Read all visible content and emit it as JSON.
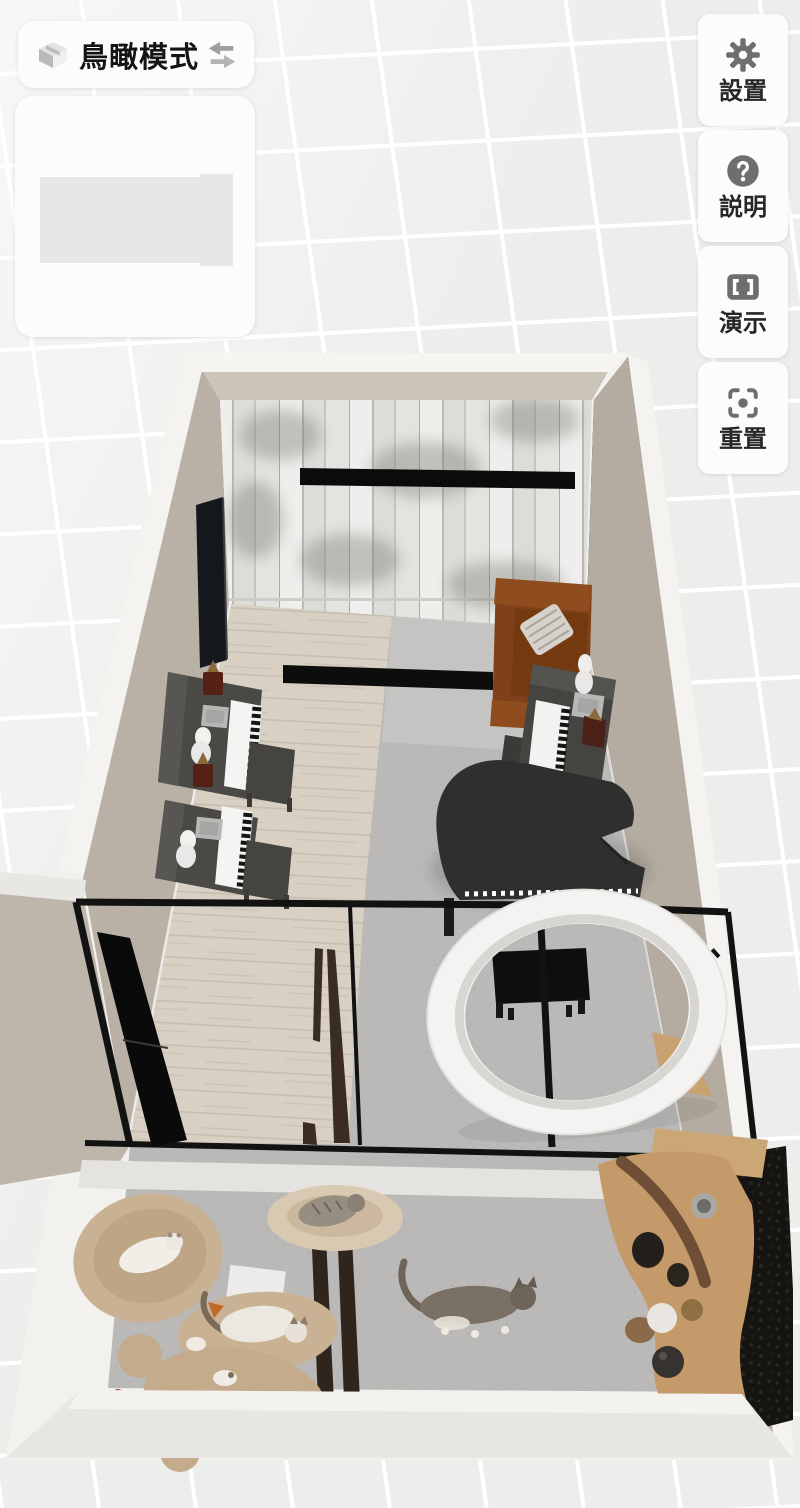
{
  "mode_button": {
    "label": "鳥瞰模式",
    "icon": "isometric-box-icon",
    "switch_icon": "swap-arrows-icon"
  },
  "minimap": {
    "note": "blank preview card with gray placeholder rectangle"
  },
  "toolbar": {
    "buttons": [
      {
        "id": "settings",
        "label": "設置",
        "icon": "gear-icon"
      },
      {
        "id": "help",
        "label": "説明",
        "icon": "question-icon"
      },
      {
        "id": "demo",
        "label": "演示",
        "icon": "presentation-icon"
      },
      {
        "id": "reset",
        "label": "重置",
        "icon": "reset-icon"
      }
    ]
  },
  "scene": {
    "view": "bird's-eye 3D view of an apartment",
    "rooms": [
      "piano studio",
      "cat room"
    ],
    "objects": [
      "marble feature wall",
      "wall light bar",
      "wall-mounted tv",
      "upright piano x3",
      "piano bench x3",
      "metronome x3",
      "white bust x3",
      "sheet music stack",
      "grand piano",
      "grand piano bench",
      "brown leather sofa",
      "striped pillow",
      "white ceiling ring light",
      "glass partition with black frame",
      "black door panel",
      "dark brown door posts",
      "cat bed x2",
      "cat tree with platforms",
      "white cat x2",
      "gray tabby cat x2",
      "wooden cat climbing shelf",
      "black boucle wall panel"
    ],
    "colors": {
      "background_grid": "#edeeec",
      "wall_beige": "#b9b1a6",
      "wall_top_white": "#f4f3f0",
      "marble": "#e7e7e4",
      "floor_wood": "#d7d0c3",
      "floor_carpet": "#bab9b7",
      "piano_dark": "#4a4946",
      "grand_piano": "#2f2f2d",
      "sofa_brown": "#7e4119",
      "ring_white": "#f4f3f1",
      "cat_tree_tan": "#c9b194",
      "shelf_wood": "#c49a6b",
      "frame_black": "#121212",
      "door_brown": "#3a2c21"
    }
  }
}
